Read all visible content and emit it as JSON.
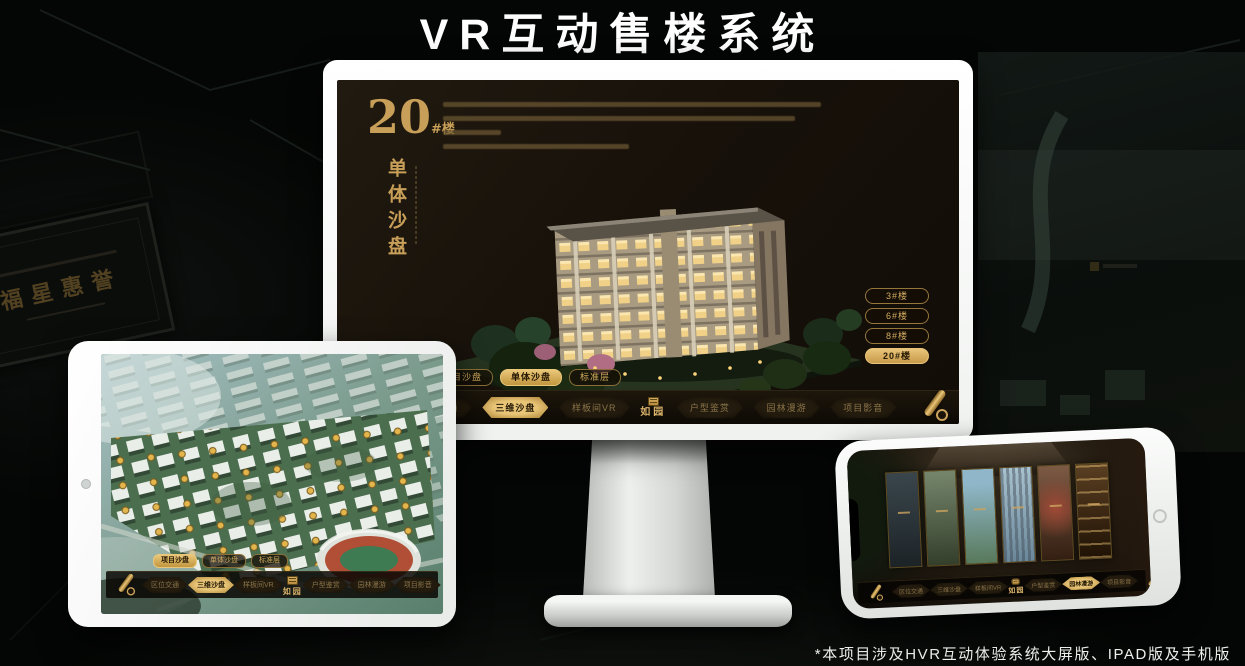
{
  "page": {
    "title": "VR互动售楼系统",
    "footnote": "*本项目涉及HVR互动体验系统大屏版、IPAD版及手机版"
  },
  "colors": {
    "gold": "#c9a35c",
    "gold_bright": "#eac779",
    "screen_bg": "#17110a",
    "white": "#ffffff"
  },
  "background": {
    "plaque_text": "福星惠誉"
  },
  "monitor": {
    "block_title_number": "20",
    "block_title_unit": "#楼",
    "block_title_vertical": "单体沙盘",
    "floor_buttons": [
      {
        "label": "3#楼",
        "active": false
      },
      {
        "label": "6#楼",
        "active": false
      },
      {
        "label": "8#楼",
        "active": false
      },
      {
        "label": "20#楼",
        "active": true
      }
    ],
    "subtabs": [
      {
        "label": "项目沙盘",
        "active": false
      },
      {
        "label": "单体沙盘",
        "active": true
      },
      {
        "label": "标准层",
        "active": false
      }
    ],
    "nav_items": [
      {
        "label": "区位交通",
        "active": false
      },
      {
        "label": "三维沙盘",
        "active": true
      },
      {
        "label": "样板间VR",
        "active": false
      },
      {
        "label": "户型鉴赏",
        "active": false
      },
      {
        "label": "园林漫游",
        "active": false
      },
      {
        "label": "项目影音",
        "active": false
      }
    ],
    "logo": "如园"
  },
  "tablet": {
    "subtabs": [
      {
        "label": "项目沙盘",
        "active": true
      },
      {
        "label": "单体沙盘",
        "active": false
      },
      {
        "label": "标准层",
        "active": false
      }
    ],
    "nav_items": [
      {
        "label": "区位交通",
        "active": false
      },
      {
        "label": "三维沙盘",
        "active": true
      },
      {
        "label": "样板间VR",
        "active": false
      },
      {
        "label": "户型鉴赏",
        "active": false
      },
      {
        "label": "园林漫游",
        "active": false
      },
      {
        "label": "项目影音",
        "active": false
      }
    ],
    "logo": "如园"
  },
  "phone": {
    "nav_items": [
      {
        "label": "区位交通",
        "active": false
      },
      {
        "label": "三维沙盘",
        "active": false
      },
      {
        "label": "样板间VR",
        "active": false
      },
      {
        "label": "户型鉴赏",
        "active": false
      },
      {
        "label": "园林漫游",
        "active": true
      },
      {
        "label": "项目影音",
        "active": false
      }
    ],
    "logo": "如园"
  }
}
